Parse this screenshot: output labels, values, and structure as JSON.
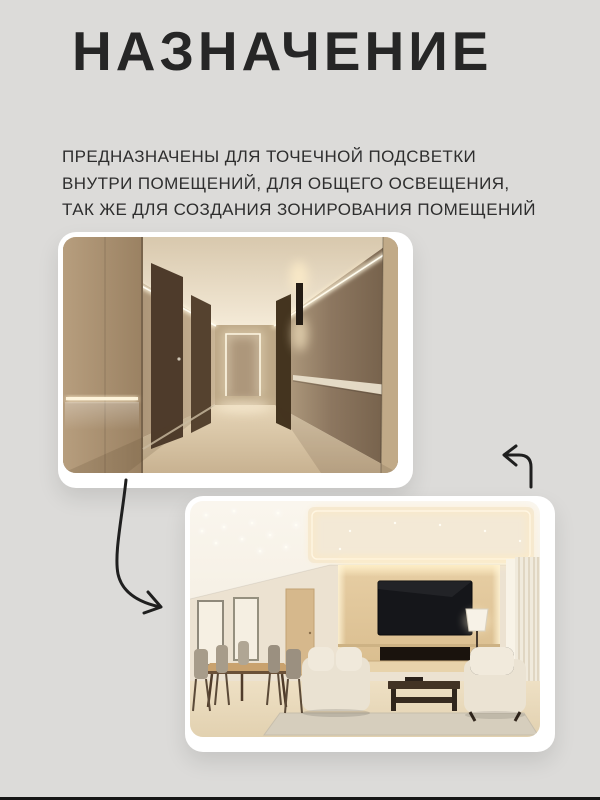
{
  "canvas": {
    "background_color": "#dcdbd9",
    "bottom_edge_color": "#161616"
  },
  "header": {
    "title": "НАЗНАЧЕНИЕ",
    "title_color": "#262626",
    "subtitle_color": "#2e2e2e",
    "subtitle_lines": [
      "ПРЕДНАЗНАЧЕНЫ ДЛЯ ТОЧЕЧНОЙ ПОДСВЕТКИ",
      "ВНУТРИ ПОМЕЩЕНИЙ, ДЛЯ ОБЩЕГО ОСВЕЩЕНИЯ,",
      "ТАК ЖЕ ДЛЯ СОЗДАНИЯ ЗОНИРОВАНИЯ ПОМЕЩЕНИЙ"
    ]
  },
  "photos": {
    "corridor": {
      "description": "Коридор с линейной светодиодной подсветкой потолка и стен",
      "frame_color": "#ffffff"
    },
    "living_room": {
      "description": "Гостиная с точечной подсветкой и световым зонированием",
      "frame_color": "#ffffff"
    }
  },
  "decorations": {
    "arrow_color": "#1f1f1f",
    "arrow_down_right": "curved-arrow-down-right",
    "arrow_up_left": "hook-arrow-up-left"
  }
}
